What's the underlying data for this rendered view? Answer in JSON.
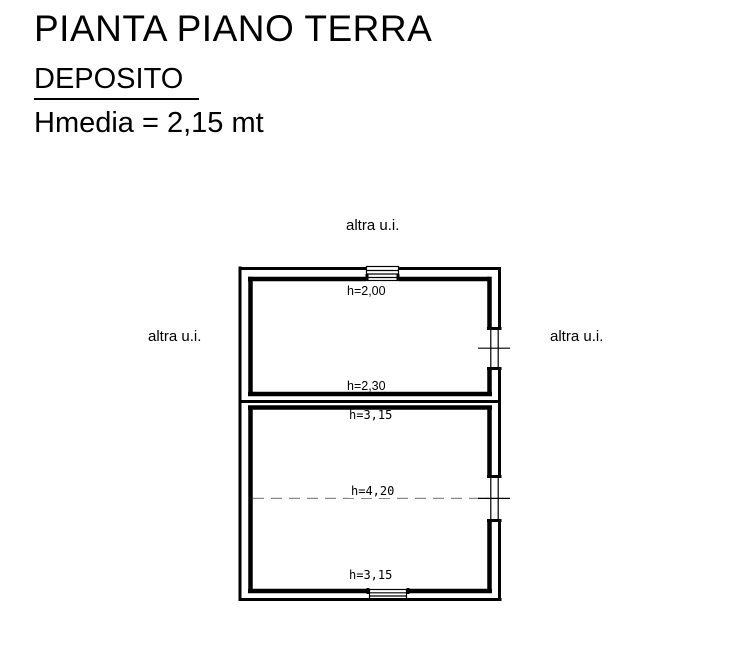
{
  "header": {
    "title": "PIANTA PIANO TERRA",
    "room_name": "DEPOSITO",
    "avg_height": "Hmedia = 2,15 mt"
  },
  "plan": {
    "neighbor_top": "altra u.i.",
    "neighbor_left": "altra u.i.",
    "neighbor_right": "altra u.i.",
    "heights": {
      "room1_top": "h=2,00",
      "room1_bottom": "h=2,30",
      "room2_top": "h=3,15",
      "room2_middle": "h=4,20",
      "room2_bottom": "h=3,15"
    },
    "colors": {
      "wall": "#000000",
      "dashed_line": "#8a8a8a",
      "background": "#ffffff",
      "text": "#000000"
    }
  }
}
